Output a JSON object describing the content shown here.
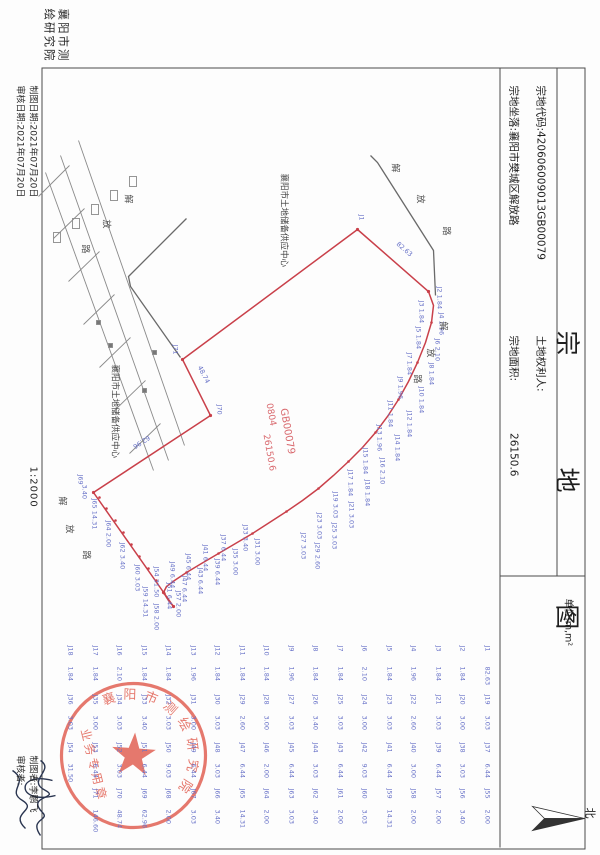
{
  "header": {
    "title": "宗 地 图",
    "unit_label": "单位:m,m²",
    "parcel_code_label": "宗地代码:",
    "parcel_code": "420606009013GB00079",
    "location_label": "宗地坐落:",
    "location": "襄阳市樊城区解放路",
    "holder_label": "土地权利人:",
    "holder": "",
    "area_label": "宗地面积:",
    "area": "26150.6",
    "north_label": "北"
  },
  "footer": {
    "agency": "襄阳市测绘研究院",
    "draw_date": "制图日期:2021年07月20日",
    "review_date": "审核日期:2021年07月20日",
    "scale": "1:2000",
    "drafter": "制图者:李鹏飞",
    "reviewer": "审核者:"
  },
  "stamp": {
    "arc_text": "襄阳市测绘研究院",
    "line_text": "业务专用章"
  },
  "map": {
    "parcel_no": "GB00079",
    "parcel_class": "0804",
    "parcel_area": "26150.6",
    "occupant": "襄阳市土地储备供应中心",
    "labels": [
      {
        "t": "J1",
        "x": 214,
        "y": 236
      },
      {
        "t": "82.63",
        "x": 243,
        "y": 200,
        "r": -49
      },
      {
        "t": "J2 1.84",
        "x": 286,
        "y": 158
      },
      {
        "t": "J3 1.84",
        "x": 300,
        "y": 176
      },
      {
        "t": "J4 1.96",
        "x": 312,
        "y": 156
      },
      {
        "t": "J5 1.84",
        "x": 326,
        "y": 179
      },
      {
        "t": "J6 2.10",
        "x": 338,
        "y": 160
      },
      {
        "t": "J7 1.84",
        "x": 352,
        "y": 188
      },
      {
        "t": "J8 1.84",
        "x": 362,
        "y": 166
      },
      {
        "t": "J9 1.96",
        "x": 376,
        "y": 197
      },
      {
        "t": "J10 1.84",
        "x": 386,
        "y": 176
      },
      {
        "t": "J11 1.84",
        "x": 400,
        "y": 207
      },
      {
        "t": "J12 1.84",
        "x": 410,
        "y": 188
      },
      {
        "t": "J13 1.96",
        "x": 424,
        "y": 218
      },
      {
        "t": "J14 1.84",
        "x": 434,
        "y": 200
      },
      {
        "t": "J15 1.84",
        "x": 447,
        "y": 232
      },
      {
        "t": "J16 2.10",
        "x": 457,
        "y": 215
      },
      {
        "t": "J17 1.84",
        "x": 469,
        "y": 247
      },
      {
        "t": "J18 1.84",
        "x": 479,
        "y": 230
      },
      {
        "t": "J19 3.03",
        "x": 491,
        "y": 262
      },
      {
        "t": "J21 3.03",
        "x": 501,
        "y": 246
      },
      {
        "t": "J23 3.03",
        "x": 512,
        "y": 278
      },
      {
        "t": "J25 3.03",
        "x": 522,
        "y": 263
      },
      {
        "t": "J27 3.03",
        "x": 532,
        "y": 294
      },
      {
        "t": "J29 2.60",
        "x": 542,
        "y": 280
      },
      {
        "t": "J31 3.00",
        "x": 538,
        "y": 340
      },
      {
        "t": "J33 3.40",
        "x": 524,
        "y": 352
      },
      {
        "t": "J35 3.00",
        "x": 548,
        "y": 362
      },
      {
        "t": "J37 6.44",
        "x": 534,
        "y": 374
      },
      {
        "t": "J39 6.44",
        "x": 558,
        "y": 380
      },
      {
        "t": "J41 6.44",
        "x": 544,
        "y": 392
      },
      {
        "t": "J43 6.44",
        "x": 567,
        "y": 397
      },
      {
        "t": "J45 6.44",
        "x": 553,
        "y": 409
      },
      {
        "t": "J47 6.44",
        "x": 575,
        "y": 413
      },
      {
        "t": "J49 6.44",
        "x": 561,
        "y": 425
      },
      {
        "t": "J51 6.44",
        "x": 582,
        "y": 428
      },
      {
        "t": "J54 31.50",
        "x": 566,
        "y": 441
      },
      {
        "t": "J57 2.00",
        "x": 590,
        "y": 419
      },
      {
        "t": "J58 2.00",
        "x": 603,
        "y": 441
      },
      {
        "t": "J59 14.31",
        "x": 586,
        "y": 452
      },
      {
        "t": "J60 3.03",
        "x": 564,
        "y": 460
      },
      {
        "t": "J62 3.40",
        "x": 542,
        "y": 475
      },
      {
        "t": "J64 2.00",
        "x": 520,
        "y": 489
      },
      {
        "t": "J65 14.31",
        "x": 498,
        "y": 503
      },
      {
        "t": "3.40",
        "x": 484,
        "y": 513
      },
      {
        "t": "J69",
        "x": 474,
        "y": 517
      },
      {
        "t": "62.96",
        "x": 436,
        "y": 448,
        "r": 57
      },
      {
        "t": "J70",
        "x": 404,
        "y": 378
      },
      {
        "t": "48.74",
        "x": 366,
        "y": 398,
        "r": -27
      },
      {
        "t": "J71",
        "x": 344,
        "y": 422
      },
      {
        "t": "解",
        "x": 163,
        "y": 203,
        "c": "#555",
        "s": 9
      },
      {
        "t": "放",
        "x": 194,
        "y": 178,
        "c": "#555",
        "s": 9
      },
      {
        "t": "路",
        "x": 226,
        "y": 152,
        "c": "#555",
        "s": 9
      },
      {
        "t": "解",
        "x": 321,
        "y": 155,
        "c": "#555",
        "s": 9
      },
      {
        "t": "放",
        "x": 348,
        "y": 168,
        "c": "#555",
        "s": 9
      },
      {
        "t": "路",
        "x": 374,
        "y": 181,
        "c": "#555",
        "s": 9
      },
      {
        "t": "解",
        "x": 496,
        "y": 536,
        "c": "#555",
        "s": 9
      },
      {
        "t": "放",
        "x": 524,
        "y": 529,
        "c": "#555",
        "s": 9
      },
      {
        "t": "路",
        "x": 550,
        "y": 512,
        "c": "#555",
        "s": 9
      },
      {
        "t": "解",
        "x": 194,
        "y": 470,
        "c": "#555",
        "s": 9
      },
      {
        "t": "放",
        "x": 219,
        "y": 492,
        "c": "#555",
        "s": 9
      },
      {
        "t": "路",
        "x": 244,
        "y": 513,
        "c": "#555",
        "s": 9
      },
      {
        "t": "襄阳市土地储备供应中心",
        "x": 173,
        "y": 314,
        "c": "#444",
        "s": 8.5,
        "n": "occupant-label"
      },
      {
        "t": "襄阳市土地储备供应中心",
        "x": 364,
        "y": 483,
        "c": "#444",
        "s": 8.5,
        "n": "occupant-label"
      },
      {
        "t": "GB00079",
        "x": 408,
        "y": 314,
        "c": "#d96a6f",
        "s": 10,
        "r": -10,
        "n": "parcel-number-label"
      },
      {
        "t": "0804",
        "x": 403,
        "y": 329,
        "c": "#d96a6f",
        "s": 9,
        "r": -10,
        "n": "parcel-class-label"
      },
      {
        "t": "26150.6",
        "x": 434,
        "y": 332,
        "c": "#d96a6f",
        "s": 9,
        "r": -10,
        "n": "parcel-area-label"
      }
    ]
  },
  "table": {
    "columns": [
      [
        {
          "p": "J1",
          "d": "82.63"
        },
        {
          "p": "J2",
          "d": "1.84"
        },
        {
          "p": "J3",
          "d": "1.84"
        },
        {
          "p": "J4",
          "d": "1.96"
        },
        {
          "p": "J5",
          "d": "1.84"
        },
        {
          "p": "J6",
          "d": "2.10"
        },
        {
          "p": "J7",
          "d": "1.84"
        },
        {
          "p": "J8",
          "d": "1.84"
        },
        {
          "p": "J9",
          "d": "1.96"
        },
        {
          "p": "J10",
          "d": "1.84"
        },
        {
          "p": "J11",
          "d": "1.84"
        },
        {
          "p": "J12",
          "d": "1.84"
        },
        {
          "p": "J13",
          "d": "1.96"
        },
        {
          "p": "J14",
          "d": "1.84"
        },
        {
          "p": "J15",
          "d": "1.84"
        },
        {
          "p": "J16",
          "d": "2.10"
        },
        {
          "p": "J17",
          "d": "1.84"
        },
        {
          "p": "J18",
          "d": "1.84"
        }
      ],
      [
        {
          "p": "J19",
          "d": "3.03"
        },
        {
          "p": "J20",
          "d": "3.00"
        },
        {
          "p": "J21",
          "d": "3.03"
        },
        {
          "p": "J22",
          "d": "2.60"
        },
        {
          "p": "J23",
          "d": "3.03"
        },
        {
          "p": "J24",
          "d": "3.00"
        },
        {
          "p": "J25",
          "d": "3.03"
        },
        {
          "p": "J26",
          "d": "3.40"
        },
        {
          "p": "J27",
          "d": "3.03"
        },
        {
          "p": "J28",
          "d": "3.00"
        },
        {
          "p": "J29",
          "d": "2.60"
        },
        {
          "p": "J30",
          "d": "3.03"
        },
        {
          "p": "J31",
          "d": "3.00"
        },
        {
          "p": "J32",
          "d": "3.03"
        },
        {
          "p": "J33",
          "d": "3.40"
        },
        {
          "p": "J34",
          "d": "3.03"
        },
        {
          "p": "J35",
          "d": "3.00"
        },
        {
          "p": "J36",
          "d": "3.03"
        }
      ],
      [
        {
          "p": "J37",
          "d": "6.44"
        },
        {
          "p": "J38",
          "d": "3.03"
        },
        {
          "p": "J39",
          "d": "6.44"
        },
        {
          "p": "J40",
          "d": "3.00"
        },
        {
          "p": "J41",
          "d": "6.44"
        },
        {
          "p": "J42",
          "d": "9.03"
        },
        {
          "p": "J43",
          "d": "6.44"
        },
        {
          "p": "J44",
          "d": "3.03"
        },
        {
          "p": "J45",
          "d": "6.44"
        },
        {
          "p": "J46",
          "d": "2.00"
        },
        {
          "p": "J47",
          "d": "6.44"
        },
        {
          "p": "J48",
          "d": "3.03"
        },
        {
          "p": "J49",
          "d": "6.44"
        },
        {
          "p": "J50",
          "d": "9.03"
        },
        {
          "p": "J51",
          "d": "6.44"
        },
        {
          "p": "J52",
          "d": "3.03"
        },
        {
          "p": "J53",
          "d": "6.44"
        },
        {
          "p": "J54",
          "d": "31.50"
        }
      ],
      [
        {
          "p": "J55",
          "d": "2.00"
        },
        {
          "p": "J56",
          "d": "3.40"
        },
        {
          "p": "J57",
          "d": "2.00"
        },
        {
          "p": "J58",
          "d": "2.00"
        },
        {
          "p": "J59",
          "d": "14.31"
        },
        {
          "p": "J60",
          "d": "3.03"
        },
        {
          "p": "J61",
          "d": "2.00"
        },
        {
          "p": "J62",
          "d": "3.40"
        },
        {
          "p": "J63",
          "d": "3.03"
        },
        {
          "p": "J64",
          "d": "2.00"
        },
        {
          "p": "J65",
          "d": "14.31"
        },
        {
          "p": "J66",
          "d": "3.40"
        },
        {
          "p": "J67",
          "d": "3.03"
        },
        {
          "p": "J68",
          "d": "2.00"
        },
        {
          "p": "J69",
          "d": "62.96"
        },
        {
          "p": "J70",
          "d": "48.74"
        },
        {
          "p": "J71",
          "d": "146.60"
        }
      ]
    ]
  }
}
